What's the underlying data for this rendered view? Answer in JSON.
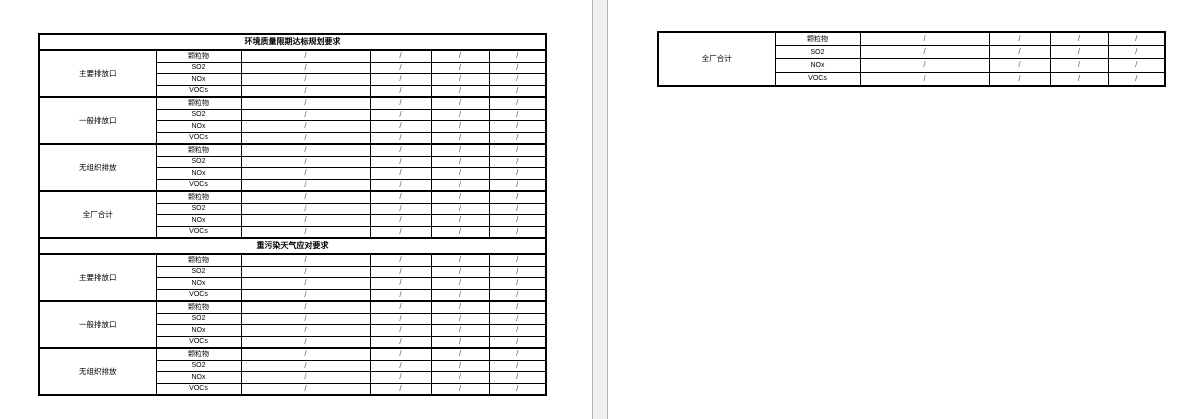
{
  "document": {
    "canvas_bg": "#efefef",
    "page_bg": "#ffffff",
    "page_edge_color": "#b3b3b3",
    "table_border_color": "#000000",
    "slash_color": "#555555"
  },
  "page1": {
    "sections": [
      {
        "title": "环境质量限期达标规划要求",
        "groups": [
          {
            "label": "主要排放口",
            "rows": [
              {
                "pollutant": "颗粒物",
                "values": [
                  "/",
                  "/",
                  "/",
                  "/"
                ]
              },
              {
                "pollutant": "SO2",
                "values": [
                  "/",
                  "/",
                  "/",
                  "/"
                ]
              },
              {
                "pollutant": "NOx",
                "values": [
                  "/",
                  "/",
                  "/",
                  "/"
                ]
              },
              {
                "pollutant": "VOCs",
                "values": [
                  "/",
                  "/",
                  "/",
                  "/"
                ]
              }
            ]
          },
          {
            "label": "一般排放口",
            "rows": [
              {
                "pollutant": "颗粒物",
                "values": [
                  "/",
                  "/",
                  "/",
                  "/"
                ]
              },
              {
                "pollutant": "SO2",
                "values": [
                  "/",
                  "/",
                  "/",
                  "/"
                ]
              },
              {
                "pollutant": "NOx",
                "values": [
                  "/",
                  "/",
                  "/",
                  "/"
                ]
              },
              {
                "pollutant": "VOCs",
                "values": [
                  "/",
                  "/",
                  "/",
                  "/"
                ]
              }
            ]
          },
          {
            "label": "无组织排放",
            "rows": [
              {
                "pollutant": "颗粒物",
                "values": [
                  "/",
                  "/",
                  "/",
                  "/"
                ]
              },
              {
                "pollutant": "SO2",
                "values": [
                  "/",
                  "/",
                  "/",
                  "/"
                ]
              },
              {
                "pollutant": "NOx",
                "values": [
                  "/",
                  "/",
                  "/",
                  "/"
                ]
              },
              {
                "pollutant": "VOCs",
                "values": [
                  "/",
                  "/",
                  "/",
                  "/"
                ]
              }
            ]
          },
          {
            "label": "全厂合计",
            "rows": [
              {
                "pollutant": "颗粒物",
                "values": [
                  "/",
                  "/",
                  "/",
                  "/"
                ]
              },
              {
                "pollutant": "SO2",
                "values": [
                  "/",
                  "/",
                  "/",
                  "/"
                ]
              },
              {
                "pollutant": "NOx",
                "values": [
                  "/",
                  "/",
                  "/",
                  "/"
                ]
              },
              {
                "pollutant": "VOCs",
                "values": [
                  "/",
                  "/",
                  "/",
                  "/"
                ]
              }
            ]
          }
        ]
      },
      {
        "title": "重污染天气应对要求",
        "groups": [
          {
            "label": "主要排放口",
            "rows": [
              {
                "pollutant": "颗粒物",
                "values": [
                  "/",
                  "/",
                  "/",
                  "/"
                ]
              },
              {
                "pollutant": "SO2",
                "values": [
                  "/",
                  "/",
                  "/",
                  "/"
                ]
              },
              {
                "pollutant": "NOx",
                "values": [
                  "/",
                  "/",
                  "/",
                  "/"
                ]
              },
              {
                "pollutant": "VOCs",
                "values": [
                  "/",
                  "/",
                  "/",
                  "/"
                ]
              }
            ]
          },
          {
            "label": "一般排放口",
            "rows": [
              {
                "pollutant": "颗粒物",
                "values": [
                  "/",
                  "/",
                  "/",
                  "/"
                ]
              },
              {
                "pollutant": "SO2",
                "values": [
                  "/",
                  "/",
                  "/",
                  "/"
                ]
              },
              {
                "pollutant": "NOx",
                "values": [
                  "/",
                  "/",
                  "/",
                  "/"
                ]
              },
              {
                "pollutant": "VOCs",
                "values": [
                  "/",
                  "/",
                  "/",
                  "/"
                ]
              }
            ]
          },
          {
            "label": "无组织排放",
            "rows": [
              {
                "pollutant": "颗粒物",
                "values": [
                  "/",
                  "/",
                  "/",
                  "/"
                ]
              },
              {
                "pollutant": "SO2",
                "values": [
                  "/",
                  "/",
                  "/",
                  "/"
                ]
              },
              {
                "pollutant": "NOx",
                "values": [
                  "/",
                  "/",
                  "/",
                  "/"
                ]
              },
              {
                "pollutant": "VOCs",
                "values": [
                  "/",
                  "/",
                  "/",
                  "/"
                ]
              }
            ]
          }
        ]
      }
    ]
  },
  "page2": {
    "sections": [
      {
        "title": null,
        "groups": [
          {
            "label": "全厂合计",
            "rows": [
              {
                "pollutant": "颗粒物",
                "values": [
                  "/",
                  "/",
                  "/",
                  "/"
                ]
              },
              {
                "pollutant": "SO2",
                "values": [
                  "/",
                  "/",
                  "/",
                  "/"
                ]
              },
              {
                "pollutant": "NOx",
                "values": [
                  "/",
                  "/",
                  "/",
                  "/"
                ]
              },
              {
                "pollutant": "VOCs",
                "values": [
                  "/",
                  "/",
                  "/",
                  "/"
                ]
              }
            ]
          }
        ]
      }
    ]
  }
}
